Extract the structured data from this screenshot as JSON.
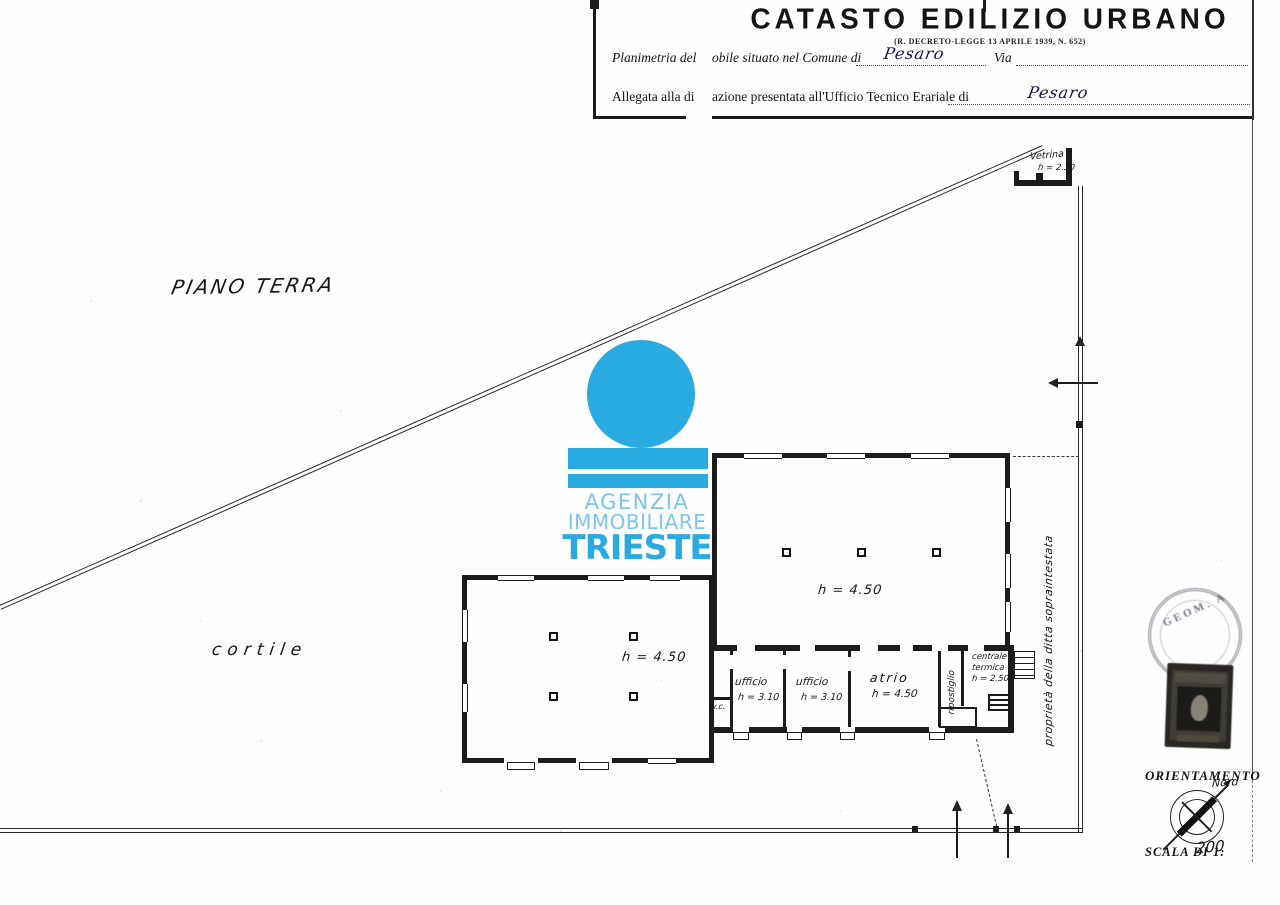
{
  "header": {
    "title": "CATASTO EDILIZIO URBANO",
    "subtitle": "(R. DECRETO-LEGGE 13 APRILE 1939, N. 652)",
    "row1_label_a": "Planimetria del",
    "row1_label_b": "obile situato nel Comune di",
    "row1_comune_value": "Pesaro",
    "row1_via_label": "Via",
    "row2_label_a": "Allegata alla di",
    "row2_label_b": "azione presentata all'Ufficio Tecnico Erariale di",
    "row2_office_value": "Pesaro"
  },
  "plan": {
    "floor_label": "PIANO TERRA",
    "courtyard_label": "cortile",
    "left_hall_height": "h = 4.50",
    "right_hall_height": "h = 4.50",
    "wc_label": "w.c.",
    "ufficio1_label": "ufficio",
    "ufficio1_height": "h = 3.10",
    "ufficio2_label": "ufficio",
    "ufficio2_height": "h = 3.10",
    "atrio_label": "atrio",
    "atrio_height": "h = 4.50",
    "ripostiglio_label": "ripostiglio",
    "centrale_line1": "centrale",
    "centrale_line2": "termica",
    "centrale_height": "h = 2.50",
    "vetrina_label": "Vetrina",
    "vetrina_height": "h = 2.30",
    "side_annotation": "proprietà della ditta sopraintestata"
  },
  "watermark": {
    "line1": "AGENZIA",
    "line2": "IMMOBILIARE",
    "line3": "TRIESTE",
    "color": "#29abe2",
    "light_color": "#7cc5eb"
  },
  "orientation": {
    "title": "ORIENTAMENTO",
    "north_label": "Nord",
    "scale_label": "SCALA DI 1:",
    "scale_value": "200"
  },
  "stamps": {
    "round_stamp_text": "GEOM. A"
  }
}
